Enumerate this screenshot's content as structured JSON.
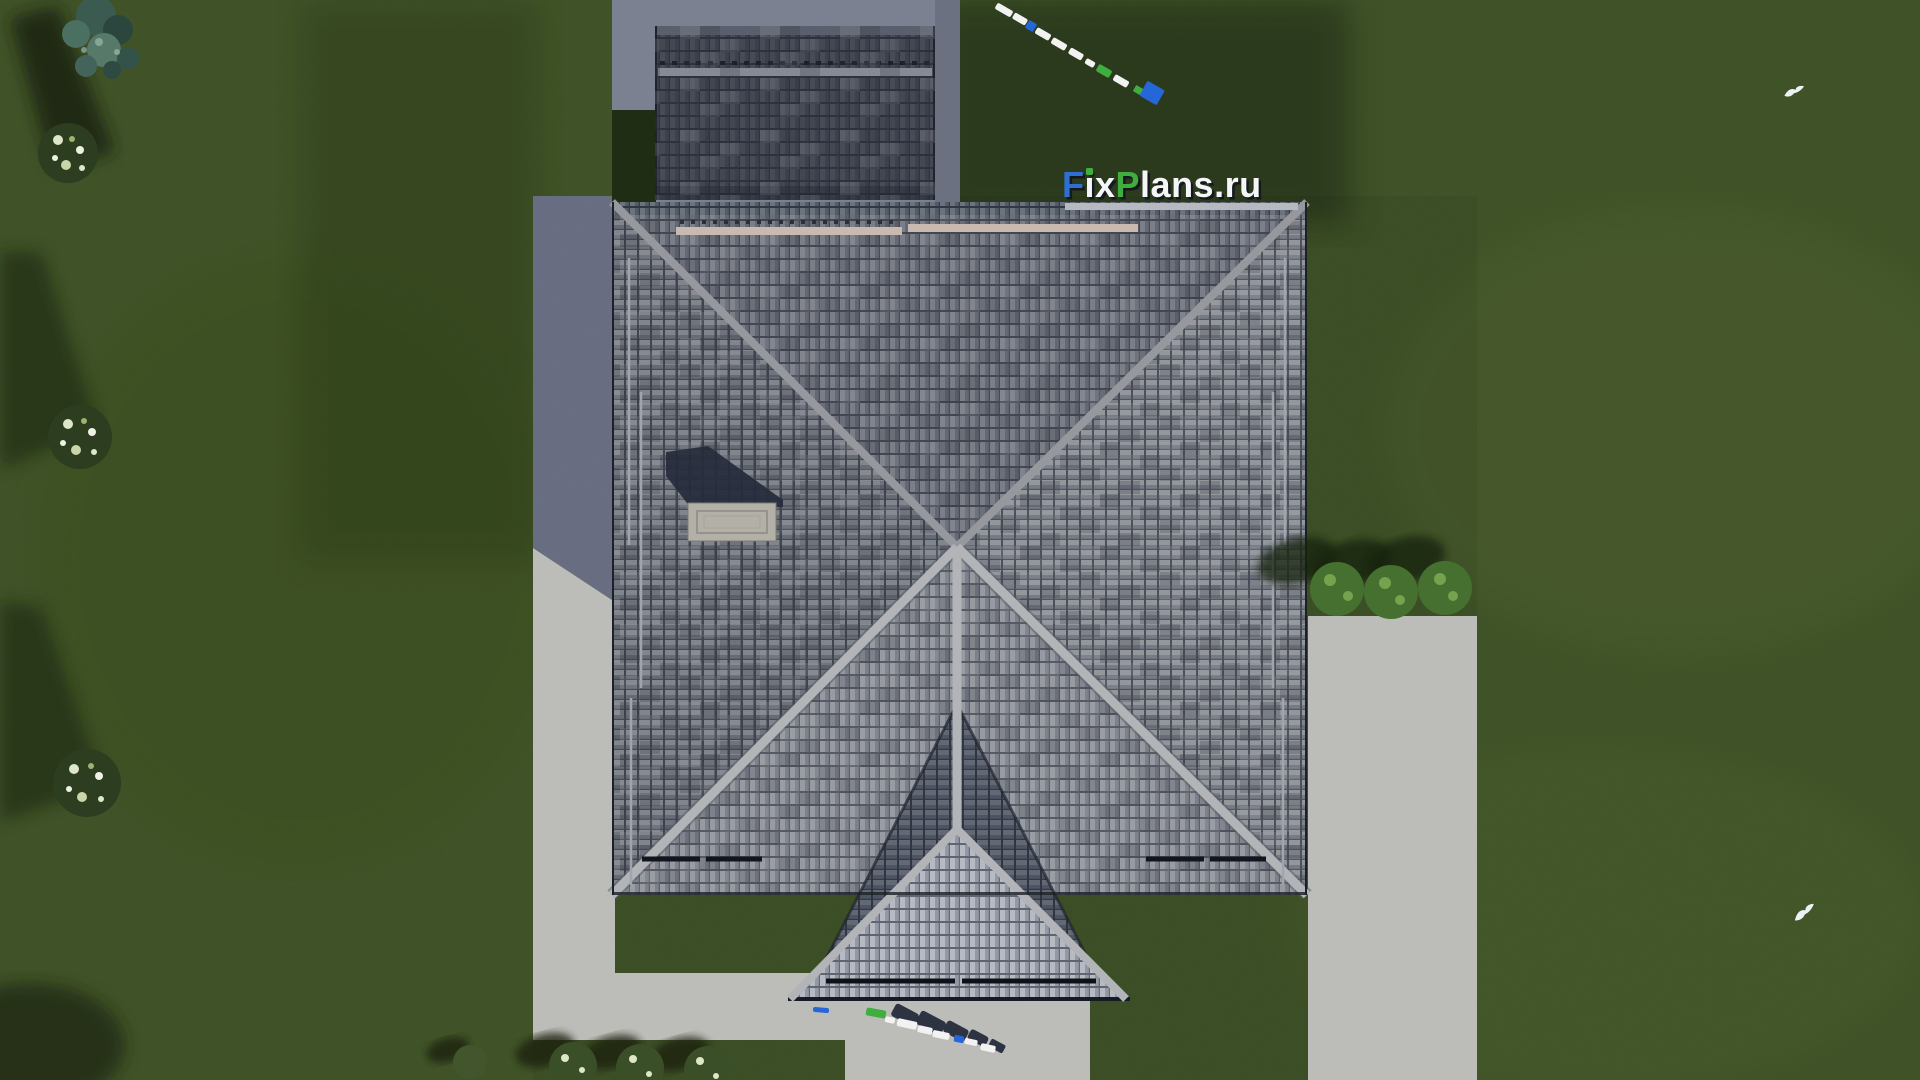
{
  "watermark": {
    "full": "FixPlans.ru",
    "part_f": "F",
    "part_ix": "ix",
    "part_p": "P",
    "part_lans": "lans",
    "part_ru": ".ru",
    "color_blue": "#2e6fd2",
    "color_green": "#3fae3f",
    "color_white": "#f4f6f8",
    "color_shadow": "#12141c"
  },
  "colors": {
    "lawn": "#4d6430",
    "lawn_light": "#64793f",
    "lawn_shadow": "#1c2a10",
    "concrete": "#c7c7c3",
    "concrete_shaded": "#6f7489",
    "pad": "#7c8191",
    "hedge": "#202d15",
    "garage_roof_dark": "#161c2e",
    "roof_tile_light": "#a8adb6",
    "roof_tile_mid": "#7b8290",
    "roof_tile_dark": "#3c4150",
    "ridge": "#b2b4b8",
    "ridge_upper": "#96989e",
    "chimney_cap": "#b3b0a8",
    "chimney_shadow": "#252b3b",
    "snowguard_light": "#c9bab1",
    "snowguard_dark": "#12151d",
    "bush_green": "#46702f",
    "bush_flower": "#dfe7c9",
    "tree_teal": "#3b5a50",
    "people_white": "#f2f2f2",
    "people_green": "#3fae3f",
    "people_blue": "#2566d8",
    "people_shadow": "#1d2434",
    "bird": "#eef2f4"
  },
  "icons": {
    "bird": "white bird in flight, top view"
  }
}
